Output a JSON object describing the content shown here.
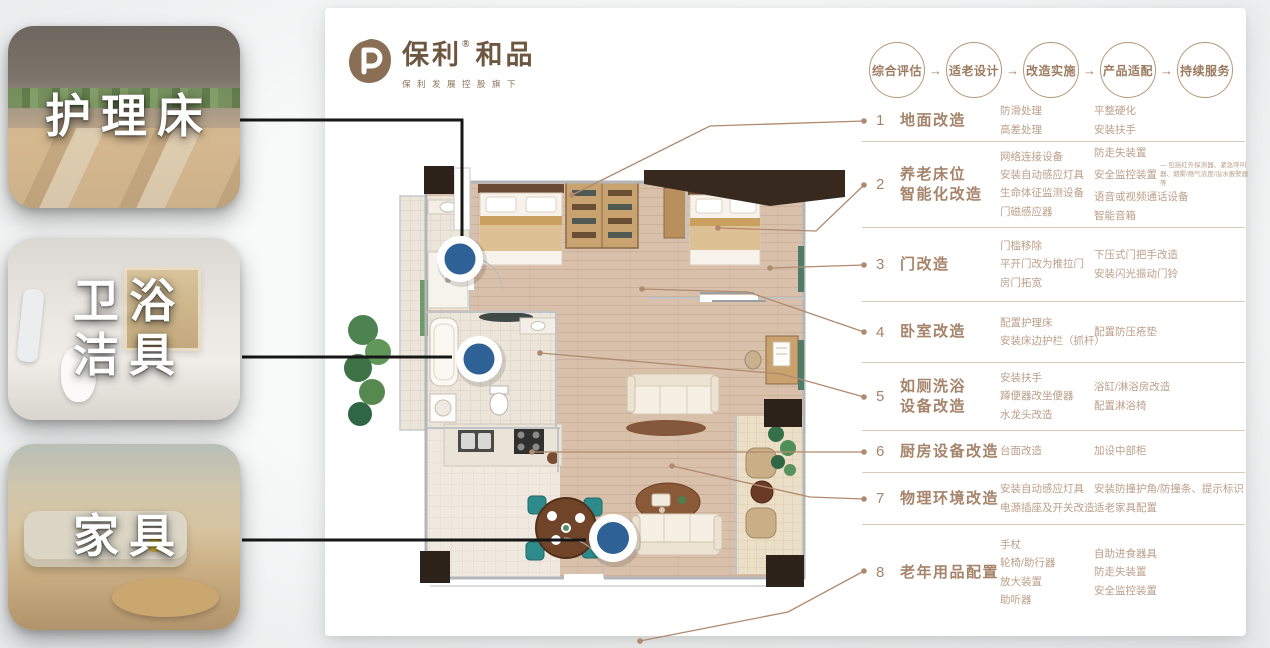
{
  "logo": {
    "name": "保利",
    "registered": "®",
    "series": "和品",
    "tagline": "保利发展控股旗下"
  },
  "process": {
    "arrow": "→",
    "steps": [
      "综合评估",
      "适老设计",
      "改造实施",
      "产品适配",
      "持续服务"
    ]
  },
  "categories": [
    {
      "num": "1",
      "title": "地面改造",
      "col1": [
        "防滑处理",
        "高差处理"
      ],
      "col2": [
        "平整硬化",
        "安装扶手"
      ]
    },
    {
      "num": "2",
      "title": "养老床位\n智能化改造",
      "col1": [
        "网络连接设备",
        "安装自动感应灯具",
        "生命体征监测设备",
        "门磁感应器"
      ],
      "col2": [
        "防走失装置",
        "安全监控装置",
        "语音或视频通话设备",
        "智能音箱"
      ],
      "col2_note_index": 1,
      "col2_note": "— 包括红外探测器、紧急呼叫器、烟雾/燃气浓度/溢水报警器等"
    },
    {
      "num": "3",
      "title": "门改造",
      "col1": [
        "门槛移除",
        "平开门改为推拉门",
        "房门拓宽"
      ],
      "col2": [
        "下压式门把手改造",
        "安装闪光振动门铃"
      ]
    },
    {
      "num": "4",
      "title": "卧室改造",
      "col1": [
        "配置护理床",
        "安装床边护栏（抓杆）"
      ],
      "col2": [
        "配置防压疮垫"
      ]
    },
    {
      "num": "5",
      "title": "如厕洗浴\n设备改造",
      "col1": [
        "安装扶手",
        "蹲便器改坐便器",
        "水龙头改造"
      ],
      "col2": [
        "浴缸/淋浴房改造",
        "配置淋浴椅"
      ]
    },
    {
      "num": "6",
      "title": "厨房设备改造",
      "col1": [
        "台面改造"
      ],
      "col2": [
        "加设中部柜"
      ]
    },
    {
      "num": "7",
      "title": "物理环境改造",
      "col1": [
        "安装自动感应灯具",
        "电源插座及开关改造"
      ],
      "col2": [
        "安装防撞护角/防撞条、提示标识",
        "适老家具配置"
      ]
    },
    {
      "num": "8",
      "title": "老年用品配置",
      "col1": [
        "手杖",
        "轮椅/助行器",
        "放大装置",
        "助听器"
      ],
      "col2": [
        "自助进食器具",
        "防走失装置",
        "安全监控装置"
      ]
    }
  ],
  "cards": [
    {
      "id": "nursing-bed",
      "label": "护理床"
    },
    {
      "id": "bath-fixtures",
      "label": "卫浴\n洁具"
    },
    {
      "id": "furniture",
      "label": "家具"
    }
  ],
  "colors": {
    "brand_brown": "#6e5740",
    "list_title": "#a5846a",
    "list_detail": "#bb9f89",
    "divider": "#dcc8b6",
    "leader_line": "#b08a6e",
    "connector_black": "#161616",
    "marker_blue": "#2e6196",
    "panel_white": "#ffffff"
  }
}
